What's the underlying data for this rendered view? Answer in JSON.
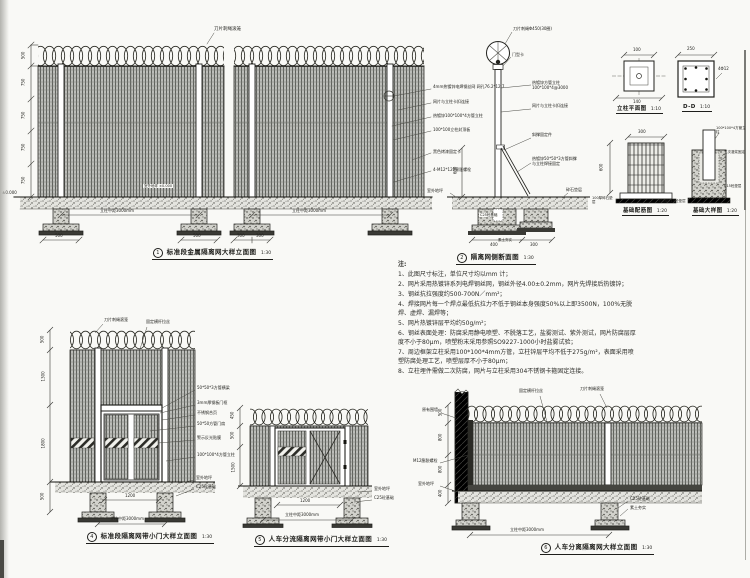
{
  "sheet": {
    "background": "#f9f9f6",
    "line_color": "#1e1e1b",
    "mesh_color": "#bcbdb9"
  },
  "captions": {
    "d1": {
      "num": "1",
      "title": "标准段金属隔离网大样立面图",
      "scale": "1:30"
    },
    "d2": {
      "num": "2",
      "title": "隔离网侧断面图",
      "scale": "1:30"
    },
    "d3a": {
      "title": "立柱平面图",
      "scale": "1:10"
    },
    "d3b": {
      "title": "D-D",
      "scale": "1:10"
    },
    "d3c": {
      "title": "基础配筋图",
      "scale": "1:20"
    },
    "d3d": {
      "title": "基础大样图",
      "scale": "1:20"
    },
    "d4": {
      "num": "4",
      "title": "标准段隔离网带小门大样立面图",
      "scale": "1:30"
    },
    "d5": {
      "num": "5",
      "title": "人车分流隔离网带小门大样立面图",
      "scale": "1:30"
    },
    "d6": {
      "num": "6",
      "title": "人车分离隔离网大样立面图",
      "scale": "1:30"
    }
  },
  "notes": {
    "title": "注:",
    "items": [
      "1、此图尺寸标注，单位尺寸均以mm 计；",
      "2、网片采用热镀锌系列电焊钢丝网，钢丝外径4.00±0.2mm，网片先焊接后热镀锌；",
      "3、钢丝抗拉强度约500-700N／mm²；",
      "4、焊接网片每一个焊点最低抗拉力不低于钢丝本身强度50%以上即3500N，100%无脱焊、虚焊、漏焊等；",
      "5、网片热镀锌层平均约50g/m²；",
      "6、钢丝表面处理：防腐采用静电喷塑、不脱落工艺，盐雾测试、紫外测试，网片防腐层厚度不小于80μm，喷塑粉末采用参照SO9227-1000小时盐雾试验；",
      "7、周边框架立柱采用100*100*4mm方管，立柱锌层平均不低于275g/m²，表面采用喷塑防腐处理工艺，喷塑层厚不小于80μm；",
      "8、立柱埋件需做二次防腐，网片与立柱采用304不锈钢卡箍固定连接。"
    ]
  },
  "d1": {
    "razor_label": "刀片刺绳滚笼",
    "callouts": [
      "4mm热镀锌电焊钢丝网 网孔76.2*12.7",
      "网片与立柱卡扣连接",
      "热镀锌100*100*4方管立柱",
      "100*100立柱封顶板",
      "黑色烤漆固定卡",
      "4-M12*120膨胀螺栓"
    ],
    "ground_label": "±0.000",
    "ground_label2": "室外地坪 ±0.000",
    "dims_left": [
      "500",
      "750",
      "750",
      "750",
      "750"
    ],
    "dim_span": "立柱中距3000mm",
    "dims_bottom": [
      "500",
      "500",
      "300",
      "300"
    ]
  },
  "d2": {
    "razor_label": "刀片刺绳Φ450(30圈)",
    "clamp_label": "门型卡",
    "callouts": [
      "热镀锌方管立柱 100*100*4@3000",
      "网片与立柱卡扣连接",
      "斜撑固定件",
      "热镀锌50*50*3方管斜撑 与立柱焊接固定"
    ],
    "ground_label": "室外地坪",
    "cushion_label": "碎石垫层",
    "footing_label": "C25砼基础",
    "soil_label": "素土夯实",
    "dim_left": "600",
    "dims_bottom": [
      "400",
      "300"
    ]
  },
  "d3": {
    "plan_dim_top": "100",
    "plan_dim_bottom": "140",
    "section_dim_top": "250",
    "section_rebar_label": "4Φ12",
    "cage_dim_left": "600",
    "cage_dim_top": "300",
    "cushion_label": "100厚碎石垫层",
    "base_labels": [
      "100*100*4方管立柱",
      "二次灌浆固定",
      "C15砼垫层"
    ],
    "mid_label": "100厚C15砼垫层"
  },
  "d4": {
    "razor_label": "刀片刺绳滚笼",
    "rail_label": "固定横杆拉丝",
    "callouts": [
      "50*50*3方管横梁",
      "3mm厚钢板门框",
      "不锈钢合页",
      "50*50方管门扇",
      "警示反光贴膜",
      "100*100*4方管立柱"
    ],
    "ground_label": "室外地坪",
    "footing_label": "C25砼基础",
    "dims_left": [
      "500",
      "1300",
      "1800",
      "500"
    ],
    "dim_door": "1200",
    "dim_span": "立柱中距3000mm"
  },
  "d5": {
    "ground_label": "室外地坪",
    "footing_label": "C25砼基础",
    "dims_left": [
      "450",
      "500",
      "1500"
    ],
    "dim_door": "1200",
    "dim_span": "立柱中距3000mm"
  },
  "d6": {
    "rail_label": "固定横杆拉丝",
    "razor_label": "刀片刺绳滚笼",
    "wall_label": "原有围墙",
    "anchor_label": "M12膨胀螺栓",
    "ground_label": "室外地坪",
    "footing_label": "C25砼基础",
    "soil_label": "素土夯实",
    "dims_left": [
      "500",
      "800",
      "800",
      "400"
    ],
    "dim_span": "立柱中距3000mm"
  }
}
